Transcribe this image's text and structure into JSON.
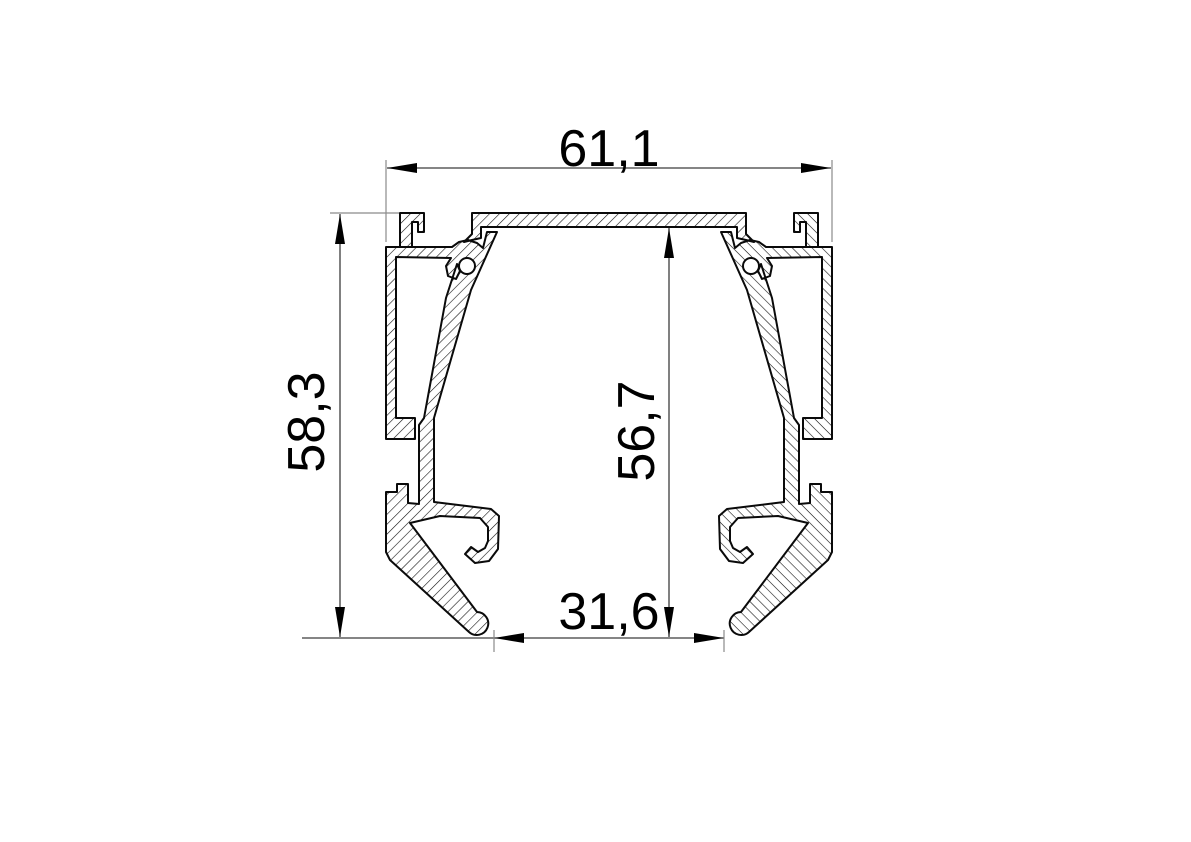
{
  "drawing": {
    "type": "profile-cross-section",
    "dimensions": {
      "overall_width": "61,1",
      "overall_height": "58,3",
      "inner_height": "56,7",
      "bottom_opening_width": "31,6"
    },
    "colors": {
      "outline": "#0a0a0a",
      "hatch": "#141414",
      "dimension_line": "#3c3c3c",
      "extension_line": "#8a8a8a",
      "arrow": "#000000",
      "text": "#000000",
      "background": "#ffffff"
    }
  }
}
